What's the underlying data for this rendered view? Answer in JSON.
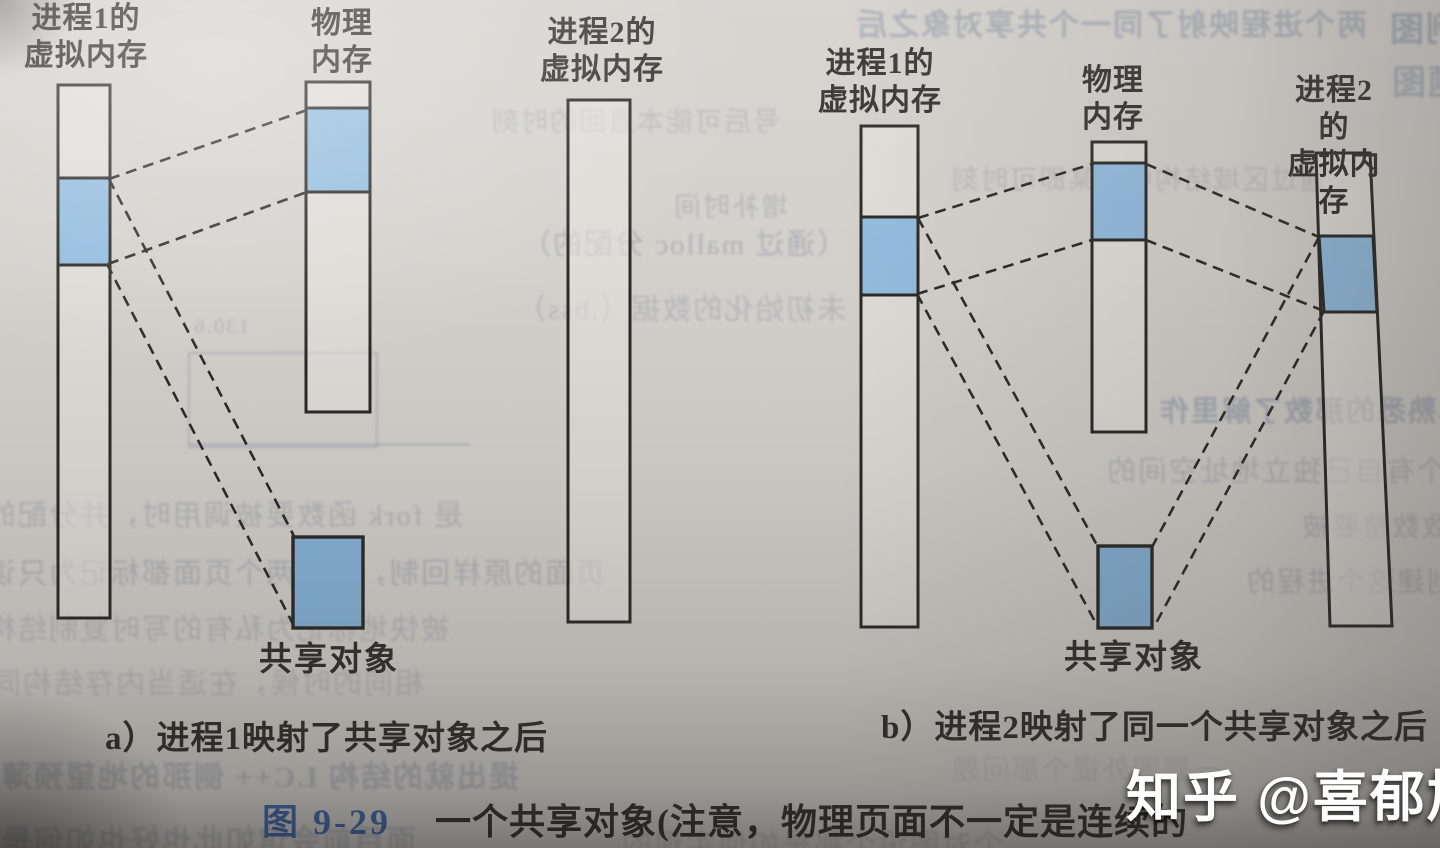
{
  "colors": {
    "paper": "#d4d1cc",
    "block_blue": "#93bcde",
    "shared_object_blue": "#88b4d9",
    "outline": "#2c2a27",
    "dash": "#2e2c29",
    "label_text": "#33302d",
    "caption_text": "#322f2b",
    "figure_number_blue": "#4064aa",
    "watermark_color": "#ffffff",
    "bleed_tint": "#6e7c96"
  },
  "diagram_a": {
    "process1_label": "进程1的\n虚拟内存",
    "physical_label": "物理\n内存",
    "process2_label": "进程2的\n虚拟内存",
    "shared_object_label": "共享对象",
    "caption": "a）进程1映射了共享对象之后"
  },
  "diagram_b": {
    "process1_label": "进程1的\n虚拟内存",
    "physical_label": "物理\n内存",
    "process2_label": "进程2的\n虚拟内存",
    "shared_object_label": "共享对象",
    "caption": "b）进程2映射了同一个共享对象之后"
  },
  "figure_caption": {
    "number": "图 9-29",
    "text": "一个共享对象(注意，物理页面不一定是连续的"
  },
  "watermark": {
    "text": "知乎 @喜郁旭"
  },
  "bleedthrough": {
    "items": [
      {
        "text": "两个进程映射了同一个共享对象之后"
      },
      {
        "text": "例图"
      },
      {
        "text": "题图"
      },
      {
        "text": "号后可能本直回的时刻"
      },
      {
        "text": "增补时间"
      },
      {
        "text": "（通过 malloc 分配的）"
      },
      {
        "text": "未初始化的数据（.bss）"
      },
      {
        "text": "130.6"
      },
      {
        "text": "已熟悉的那数了解里作"
      },
      {
        "text": "通过区域结构中的某即可时刻"
      },
      {
        "text": "一个有自己独立地址空间的"
      },
      {
        "text": "与 fork 函数数整要被"
      },
      {
        "text": "的 PID。为了创建这个进程的"
      },
      {
        "text": "是 fork 函数要被调用时，并分配的"
      },
      {
        "text": "页面的原样回制，它将两个页面都标记为只读"
      },
      {
        "text": "被快地标记为私有的写时复制结构"
      },
      {
        "text": "相同的时候，在适当内存结构同"
      },
      {
        "text": "提出就的结构 LC++ 侧那的地望预薄"
      },
      {
        "text": "面目前会馆如此也好也如何是"
      },
      {
        "text": "个对图设个那是如何实现的"
      },
      {
        "text": "一题图外提个那问题"
      }
    ]
  }
}
